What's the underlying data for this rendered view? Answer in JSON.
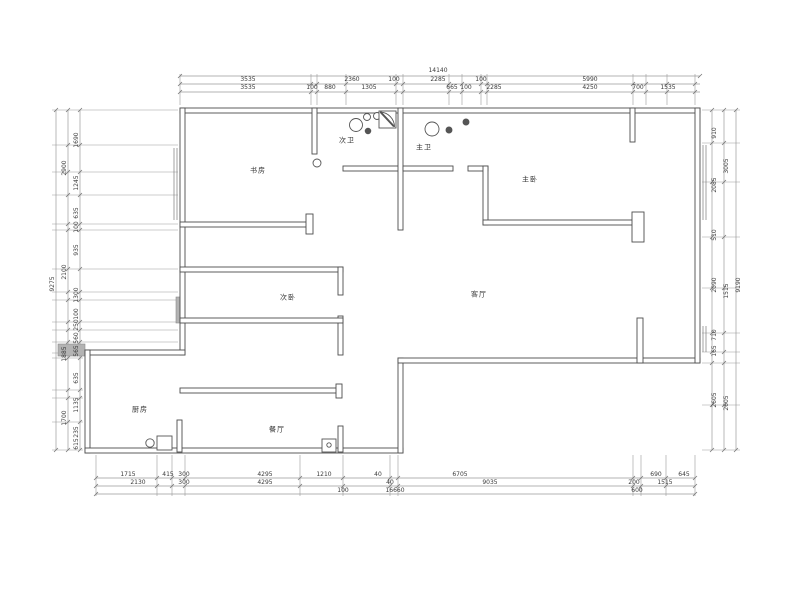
{
  "drawing": {
    "kind_label": "floor-plan"
  },
  "colors": {
    "wall": "#4d4d4d",
    "dim_line": "#9b9b9b",
    "text": "#3a3a3a",
    "gray_fill": "#b3b3b3",
    "background": "#ffffff"
  },
  "rooms": [
    {
      "id": "study",
      "label": "书房",
      "x": 258,
      "y": 171
    },
    {
      "id": "second-bath",
      "label": "次卫",
      "x": 347,
      "y": 141
    },
    {
      "id": "master-bath",
      "label": "主卫",
      "x": 424,
      "y": 148
    },
    {
      "id": "master-bedroom",
      "label": "主卧",
      "x": 530,
      "y": 180
    },
    {
      "id": "second-bedroom",
      "label": "次卧",
      "x": 288,
      "y": 298
    },
    {
      "id": "living-room",
      "label": "客厅",
      "x": 479,
      "y": 295
    },
    {
      "id": "kitchen",
      "label": "厨房",
      "x": 140,
      "y": 410
    },
    {
      "id": "dining-room",
      "label": "餐厅",
      "x": 277,
      "y": 430
    }
  ],
  "dimensions": {
    "top": {
      "total": {
        "v": "14140",
        "x": 438,
        "y": 71
      },
      "rows": [
        {
          "y": 80,
          "items": [
            {
              "v": "3535",
              "x": 248
            },
            {
              "v": "2360",
              "x": 352
            },
            {
              "v": "100",
              "x": 394
            },
            {
              "v": "2285",
              "x": 438
            },
            {
              "v": "100",
              "x": 481
            },
            {
              "v": "5990",
              "x": 590
            }
          ]
        },
        {
          "y": 88,
          "items": [
            {
              "v": "3535",
              "x": 248
            },
            {
              "v": "100",
              "x": 312
            },
            {
              "v": "880",
              "x": 330
            },
            {
              "v": "1305",
              "x": 369
            },
            {
              "v": "665",
              "x": 452
            },
            {
              "v": "100",
              "x": 466
            },
            {
              "v": "2285",
              "x": 494
            },
            {
              "v": "4250",
              "x": 590
            },
            {
              "v": "700",
              "x": 638
            },
            {
              "v": "1535",
              "x": 668
            }
          ]
        }
      ]
    },
    "bottom": {
      "rows": [
        {
          "y": 475,
          "items": [
            {
              "v": "1715",
              "x": 128
            },
            {
              "v": "415",
              "x": 168
            },
            {
              "v": "300",
              "x": 184
            },
            {
              "v": "4295",
              "x": 265
            },
            {
              "v": "1210",
              "x": 324
            },
            {
              "v": "40",
              "x": 378
            },
            {
              "v": "6705",
              "x": 460
            },
            {
              "v": "690",
              "x": 656
            },
            {
              "v": "645",
              "x": 684
            }
          ]
        },
        {
          "y": 483,
          "items": [
            {
              "v": "2130",
              "x": 138
            },
            {
              "v": "300",
              "x": 184
            },
            {
              "v": "4295",
              "x": 265
            },
            {
              "v": "40",
              "x": 390
            },
            {
              "v": "9035",
              "x": 490
            },
            {
              "v": "200",
              "x": 634
            },
            {
              "v": "1515",
              "x": 665
            }
          ]
        },
        {
          "y": 491,
          "items": [
            {
              "v": "100",
              "x": 343
            },
            {
              "v": "16660",
              "x": 395
            },
            {
              "v": "600",
              "x": 637
            }
          ]
        }
      ]
    },
    "left": {
      "cols": [
        {
          "x": 53,
          "items": [
            {
              "v": "9275",
              "y": 284
            }
          ]
        },
        {
          "x": 65,
          "items": [
            {
              "v": "2900",
              "y": 168
            },
            {
              "v": "2100",
              "y": 272
            },
            {
              "v": "1885",
              "y": 354
            },
            {
              "v": "1700",
              "y": 418
            }
          ]
        },
        {
          "x": 77,
          "items": [
            {
              "v": "1690",
              "y": 140
            },
            {
              "v": "1245",
              "y": 183
            },
            {
              "v": "635",
              "y": 213
            },
            {
              "v": "100",
              "y": 227
            },
            {
              "v": "935",
              "y": 250
            },
            {
              "v": "1300",
              "y": 295
            },
            {
              "v": "100",
              "y": 314
            },
            {
              "v": "250",
              "y": 325
            },
            {
              "v": "560",
              "y": 338
            },
            {
              "v": "565",
              "y": 351
            },
            {
              "v": "635",
              "y": 378
            },
            {
              "v": "1135",
              "y": 405
            },
            {
              "v": "235",
              "y": 432
            },
            {
              "v": "615",
              "y": 444
            }
          ]
        }
      ]
    },
    "right": {
      "cols": [
        {
          "x": 715,
          "items": [
            {
              "v": "910",
              "y": 133
            },
            {
              "v": "2085",
              "y": 185
            },
            {
              "v": "510",
              "y": 235
            },
            {
              "v": "2090",
              "y": 285
            },
            {
              "v": "710",
              "y": 335
            },
            {
              "v": "165",
              "y": 351
            },
            {
              "v": "2605",
              "y": 400
            }
          ]
        },
        {
          "x": 727,
          "items": [
            {
              "v": "3005",
              "y": 166
            },
            {
              "v": "1515",
              "y": 291
            },
            {
              "v": "2605",
              "y": 403
            }
          ]
        },
        {
          "x": 739,
          "items": [
            {
              "v": "9190",
              "y": 285
            }
          ]
        }
      ]
    }
  }
}
